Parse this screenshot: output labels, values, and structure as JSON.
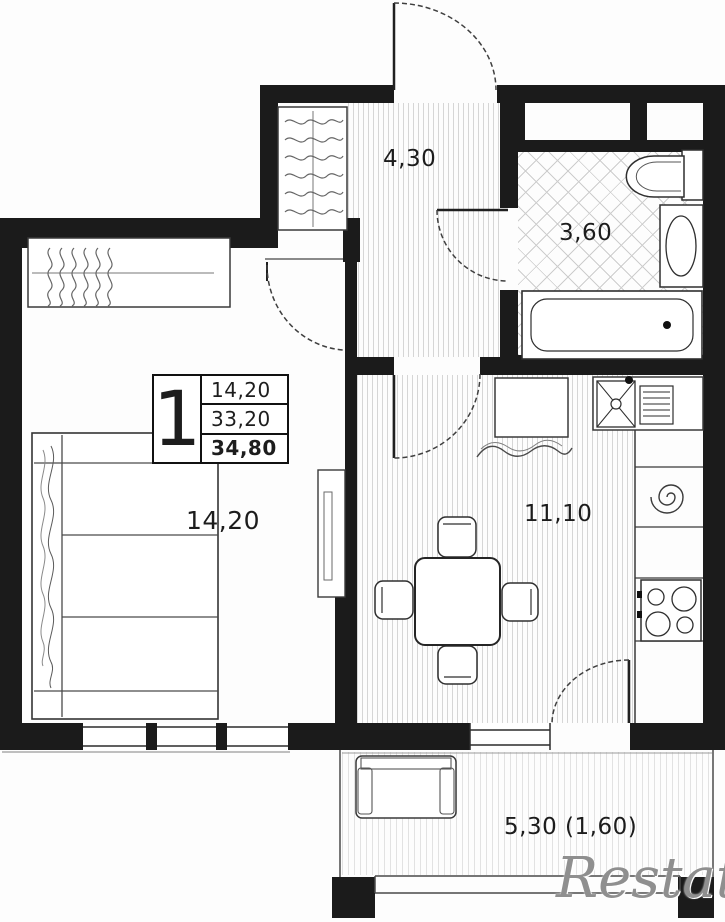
{
  "plan": {
    "areas": {
      "hallway": "4,30",
      "bathroom": "3,60",
      "living_room": "14,20",
      "kitchen": "11,10",
      "balcony": "5,30 (1,60)"
    },
    "legend": {
      "rooms_count": "1",
      "living_area": "14,20",
      "area": "33,20",
      "total_area": "34,80"
    },
    "watermark": "Restate",
    "colors": {
      "wall": "#1b1b1b",
      "line": "#3a3a3a",
      "hatch": "#d6d6d6",
      "watermark": "#8f8f8f"
    }
  }
}
